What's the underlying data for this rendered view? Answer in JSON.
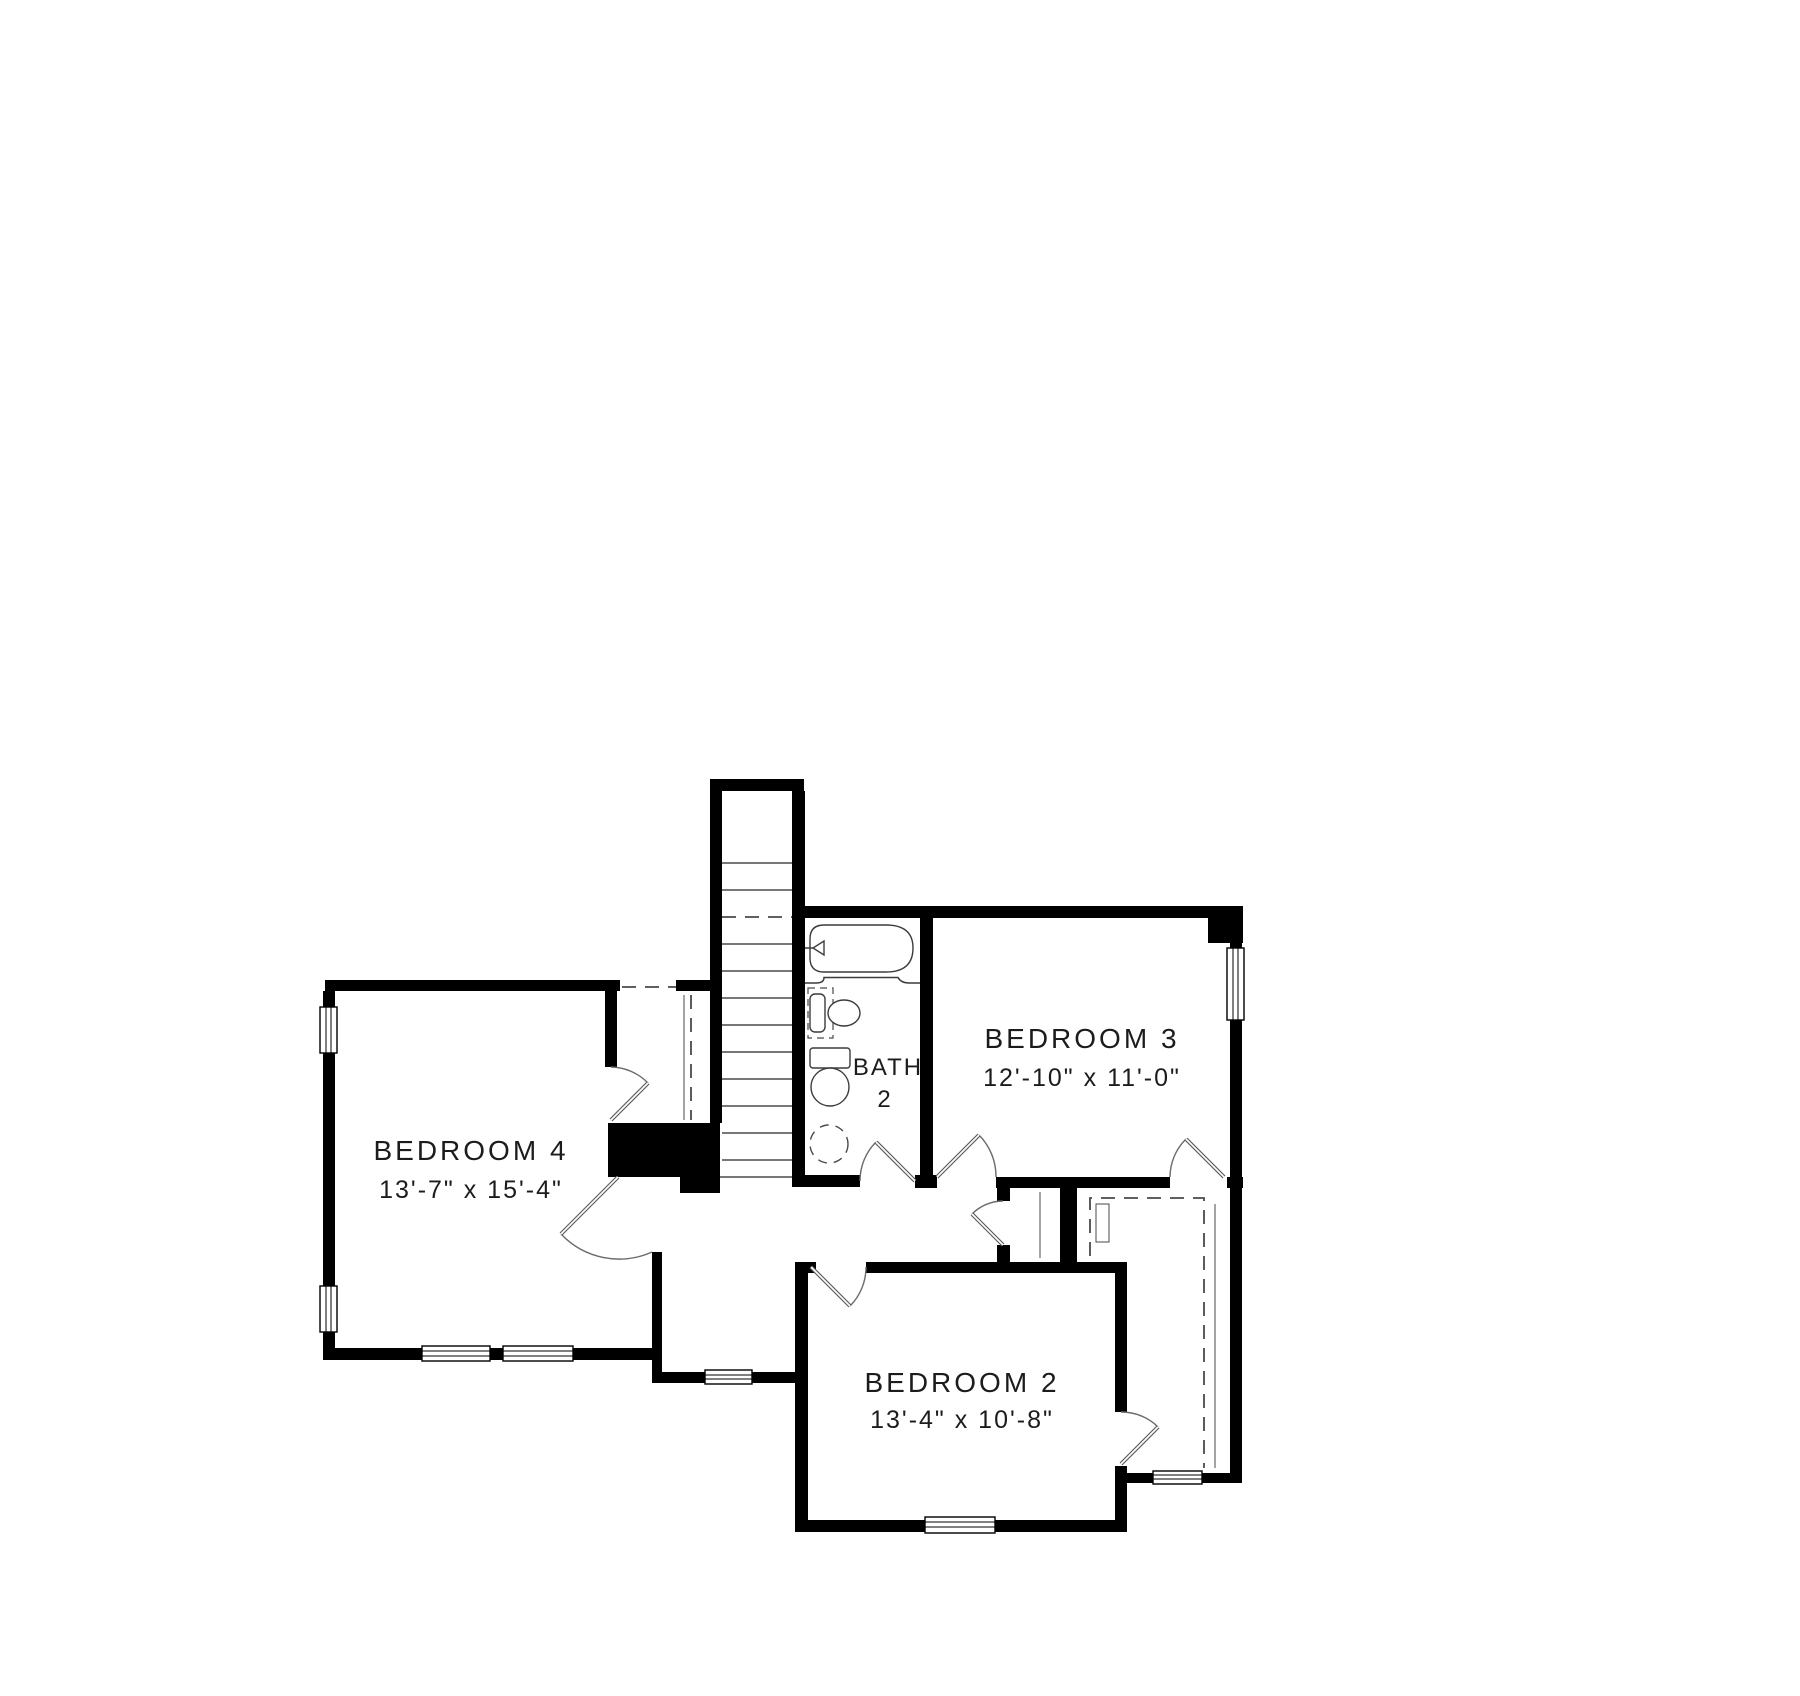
{
  "plan": {
    "type": "floor-plan-second-floor",
    "wall_color": "#000000",
    "line_color": "#4a4a4a",
    "text_color": "#1c1c1c",
    "background": "#ffffff",
    "rooms": {
      "bedroom4": {
        "name": "BEDROOM 4",
        "dims": "13'-7\" x 15'-4\""
      },
      "bedroom3": {
        "name": "BEDROOM 3",
        "dims": "12'-10\" x 11'-0\""
      },
      "bedroom2": {
        "name": "BEDROOM 2",
        "dims": "13'-4\" x 10'-8\""
      },
      "bath2": {
        "name": "BATH",
        "number": "2"
      }
    },
    "fixtures": [
      "staircase",
      "bathtub",
      "vanity-sink",
      "toilet"
    ],
    "window_count": 8,
    "door_count": 8,
    "closet_count": 3
  }
}
